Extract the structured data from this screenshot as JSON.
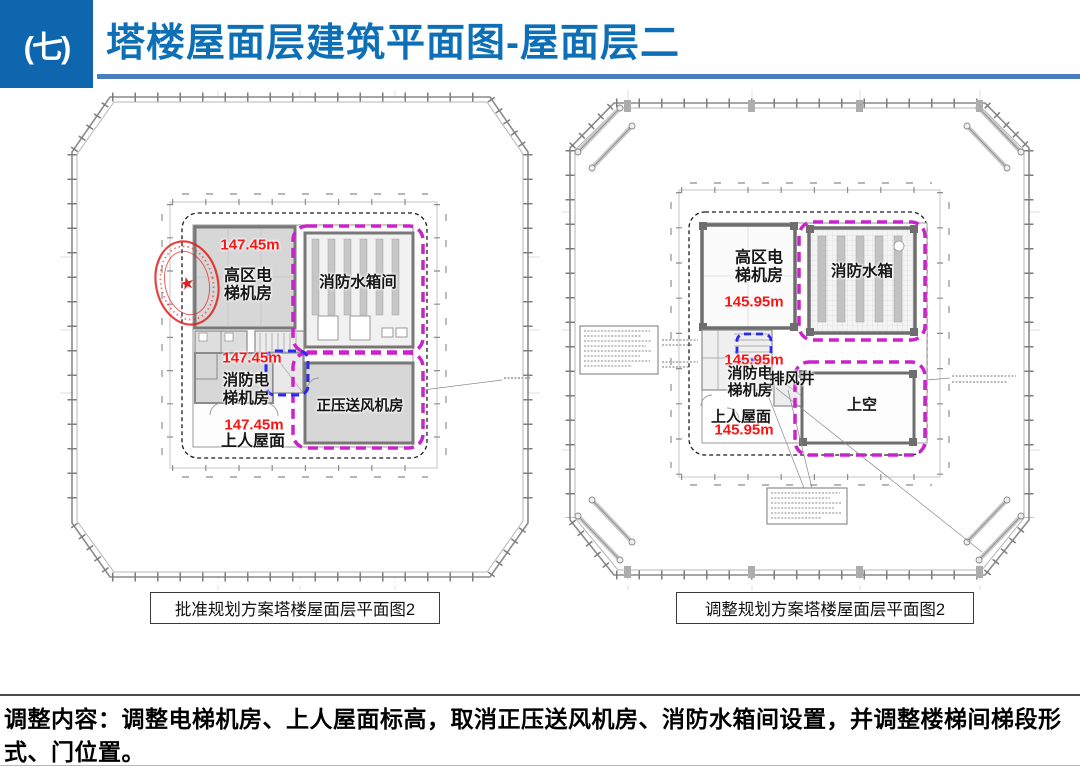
{
  "header": {
    "section_number": "(七)",
    "title": "塔楼屋面层建筑平面图-屋面层二"
  },
  "left_plan": {
    "caption": "批准规划方案塔楼屋面层平面图2",
    "elevation": "147.45m",
    "labels": {
      "high_zone_elevator_room": "高区电梯机房",
      "fire_water_tank_room": "消防水箱间",
      "fire_elevator_room": "消防电梯机房",
      "accessible_roof": "上人屋面",
      "pressurized_air_supply_room": "正压送风机房"
    }
  },
  "right_plan": {
    "caption": "调整规划方案塔楼屋面层平面图2",
    "elevation": "145.95m",
    "labels": {
      "high_zone_elevator_room": "高区电梯机房",
      "fire_water_tank": "消防水箱",
      "fire_elevator_room": "消防电梯机房",
      "exhaust_shaft": "排风井",
      "accessible_roof": "上人屋面",
      "open_to_below": "上空"
    }
  },
  "footer": {
    "text": "调整内容：调整电梯机房、上人屋面标高，取消正压送风机房、消防水箱间设置，并调整楼梯间梯段形式、门位置。"
  },
  "stamp": {
    "star": "★"
  },
  "colors": {
    "accent_blue": "#0e67ae",
    "title_blue": "#0d70b7",
    "underline_blue": "#4a7fc1",
    "elevation_red": "#fa1414",
    "highlight_magenta": "#cc22cc",
    "highlight_blue": "#2a2aee"
  }
}
